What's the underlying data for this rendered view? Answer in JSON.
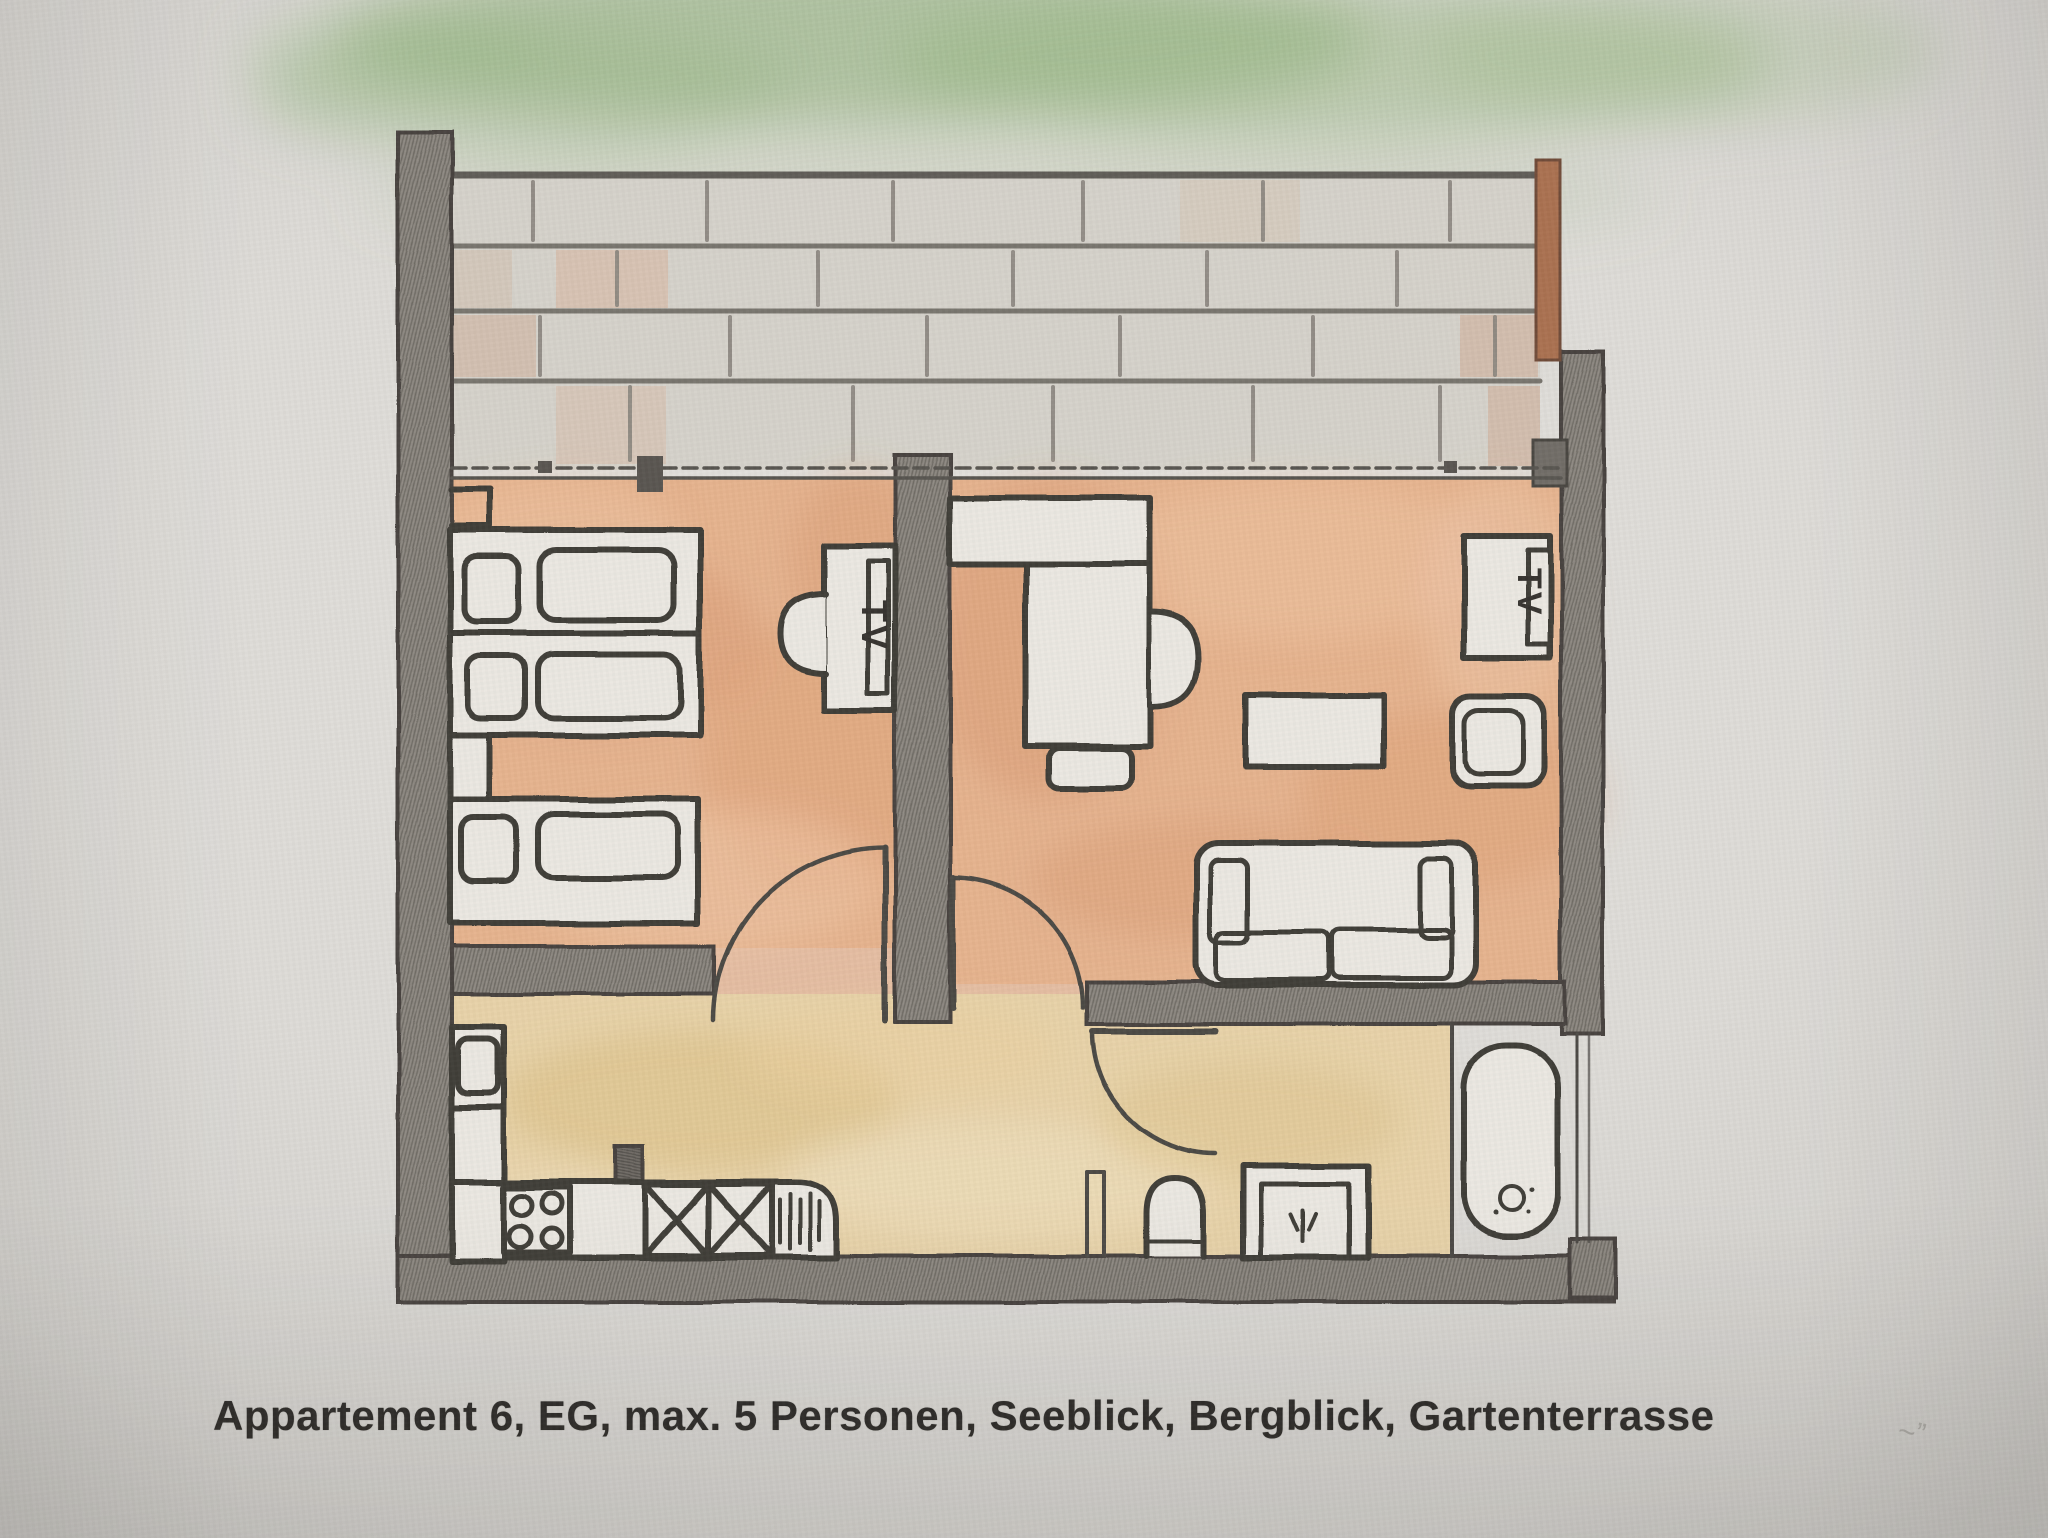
{
  "caption": "Appartement 6, EG, max. 5 Personen, Seeblick, Bergblick, Gartenterrasse",
  "labels": {
    "tv_left": "TV",
    "tv_right": "TV"
  },
  "apartment": {
    "number": "6",
    "floor": "EG",
    "max_persons": "5",
    "features": [
      "Seeblick",
      "Bergblick",
      "Gartenterrasse"
    ]
  },
  "colors": {
    "paper": "#dedcd8",
    "pencil_ink": "#3d3a36",
    "wall_gray": "#8d8881",
    "floor_bedroom_living_orange": "#e5b28d",
    "floor_kitchen_bath_tan": "#e7d2a8",
    "terrace_brick_gray": "#d5d2ca",
    "garden_green": "#8fb07a",
    "railing_brown": "#a96f4e"
  },
  "plan": {
    "areas": [
      "garden",
      "terrace",
      "bedroom",
      "living-dining-room",
      "kitchen",
      "hallway",
      "bathroom",
      "bathtub-niche"
    ],
    "fixtures": [
      "bunk-bed-upper",
      "bunk-bed-lower",
      "single-bed",
      "wall-niche",
      "tv-bedroom",
      "tv-stool",
      "dining-bench",
      "dining-table",
      "dining-chair-right",
      "dining-chair-front",
      "tv-living",
      "armchair",
      "coffee-table",
      "sofa",
      "kitchen-sink",
      "kitchen-counter",
      "stove-four-burners",
      "cabinet-x-boxes",
      "drying-rack",
      "toilet",
      "shower",
      "bathtub",
      "door-bedroom",
      "door-living-room",
      "door-bathroom",
      "terrace-paving",
      "garden-shading",
      "railing"
    ]
  }
}
